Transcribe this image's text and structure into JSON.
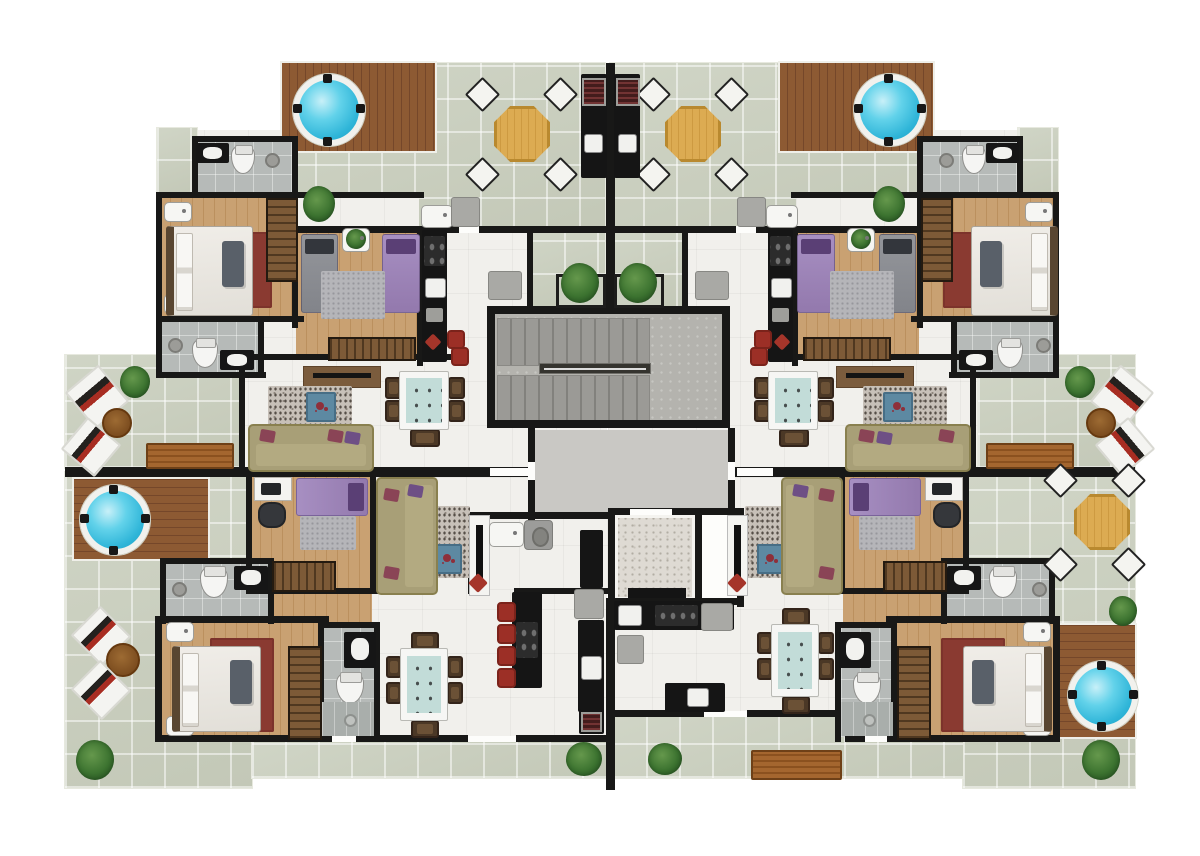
{
  "scene": {
    "type": "residential-floor-plan",
    "style": "photoreal-3d-rendered-top-view",
    "apartments": 4,
    "layout": "two upper units and two lower units mirrored around a central stair/elevator core",
    "visible_text": []
  },
  "palette": {
    "wall": "#181817",
    "terrace_tile": "#cbd0c1",
    "interior_floor": "#f1f0ec",
    "bathroom_floor": "#b6bab8",
    "wood_floor": "#c9a172",
    "wood_deck": "#8d5a33",
    "hot_tub_water": "#3ec3e4",
    "sofa_olive": "#a89f77",
    "dining_table_top": "#c2dcd8",
    "accent_red": "#9c2f26",
    "rug_red": "#8a3a31",
    "bed_purple": "#9e85b9",
    "bed_gray": "#8d9095",
    "plant_green": "#3c7330",
    "elevator_marble": "#dedad3",
    "lobby_gray": "#c9c8c4",
    "stair_concrete": "#b4b3ae"
  },
  "core": {
    "elements": [
      "double-flight staircase with center rail",
      "gray lobby with two entry doors",
      "elevator cab with marble floor",
      "white service shaft",
      "laundry room with sink, washer and pantry cabinet",
      "two planter boxes flanking center wall"
    ]
  },
  "apartments": [
    {
      "id": "upper-left",
      "rooms": [
        "roof terrace",
        "bathroom 1",
        "master bedroom",
        "bathroom 2",
        "kids bedroom",
        "linear kitchen",
        "living room",
        "dining area",
        "foyer"
      ],
      "terrace_features": [
        "round hot tub on wood deck",
        "octagonal dining table with 4 chairs",
        "bbq grill counter with sink",
        "outdoor sink unit",
        "plant"
      ],
      "furniture": [
        "double bed with white linen and gray throw",
        "2 nightstands",
        "hanger wardrobe",
        "red area rug",
        "gray single bed",
        "purple single bed",
        "kids gray rug",
        "low wardrobe",
        "black kitchen counter with cooktop and sink",
        "2 red bar stools",
        "red floor mat",
        "refrigerator cabinet",
        "tv cabinet",
        "granite rug",
        "blue coffee table",
        "olive sofa with wine and purple pillows",
        "dining table for 6 with teal top"
      ]
    },
    {
      "id": "upper-right",
      "mirror_of": "upper-left",
      "rooms": [
        "roof terrace",
        "bathroom 1",
        "master bedroom",
        "bathroom 2",
        "kids bedroom",
        "linear kitchen",
        "living room",
        "dining area",
        "foyer"
      ],
      "terrace_features": [
        "round hot tub on wood deck",
        "octagonal dining table with 4 chairs",
        "bbq grill counter with sink",
        "outdoor sink unit",
        "plant"
      ],
      "furniture": [
        "double bed",
        "2 nightstands",
        "hanger wardrobe",
        "red area rug",
        "purple single bed",
        "gray single bed",
        "kids gray rug",
        "low wardrobe",
        "black kitchen counter",
        "2 red bar stools",
        "refrigerator cabinet",
        "tv cabinet",
        "granite rug",
        "blue coffee table",
        "olive sofa",
        "dining table for 6"
      ]
    },
    {
      "id": "lower-left",
      "rooms": [
        "wrap-around terrace",
        "home office / guest room",
        "living room",
        "laundry",
        "kitchen with island",
        "dining area",
        "bathroom A",
        "master bedroom",
        "bathroom B with shower"
      ],
      "terrace_features": [
        "hot tub on wood deck",
        "2 striped lounge chairs",
        "round side table",
        "wood bench",
        "plants"
      ],
      "furniture": [
        "white desk with laptop",
        "office chair",
        "purple daybed",
        "gray rug",
        "low wardrobe",
        "olive L-sofa",
        "granite rug",
        "blue coffee table",
        "white tv panel",
        "laundry sink",
        "washing machine",
        "black pantry",
        "kitchen island with 4 red stools",
        "refrigerator",
        "black counter with sink",
        "stove with red grate",
        "dining table for 6-8 with teal top",
        "double bed",
        "red rug",
        "2 nightstands",
        "tall hanger wardrobe",
        "2 vanities",
        "2 toilets",
        "shower area with drain"
      ]
    },
    {
      "id": "lower-right",
      "mirror_of": "lower-left",
      "rooms": [
        "wrap-around terrace",
        "home office / guest room",
        "living room",
        "kitchen along wall",
        "dining area",
        "bathroom A",
        "master bedroom",
        "bathroom B with shower"
      ],
      "terrace_features": [
        "octagonal dining table with 4 chairs",
        "hot tub on wood deck",
        "2 striped lounge chairs",
        "round side table",
        "wood bench",
        "plants"
      ],
      "furniture": [
        "white desk with laptop",
        "office chair",
        "purple daybed",
        "gray rug",
        "low wardrobe",
        "olive L-sofa",
        "granite rug",
        "blue coffee table",
        "white tv panel",
        "wall kitchen counter with sink, cooktop and appliance",
        "service cart",
        "island with sink",
        "dining table for 6-8",
        "double bed",
        "red rug",
        "2 nightstands",
        "tall hanger wardrobe",
        "2 vanities",
        "2 toilets",
        "shower area with drain"
      ]
    }
  ],
  "shared_terrace_items": {
    "hot_tubs": 4,
    "octagonal_tables": 3,
    "bbq_grills": 2,
    "benches": 3,
    "lounge_chairs": 6,
    "plants": 13
  }
}
